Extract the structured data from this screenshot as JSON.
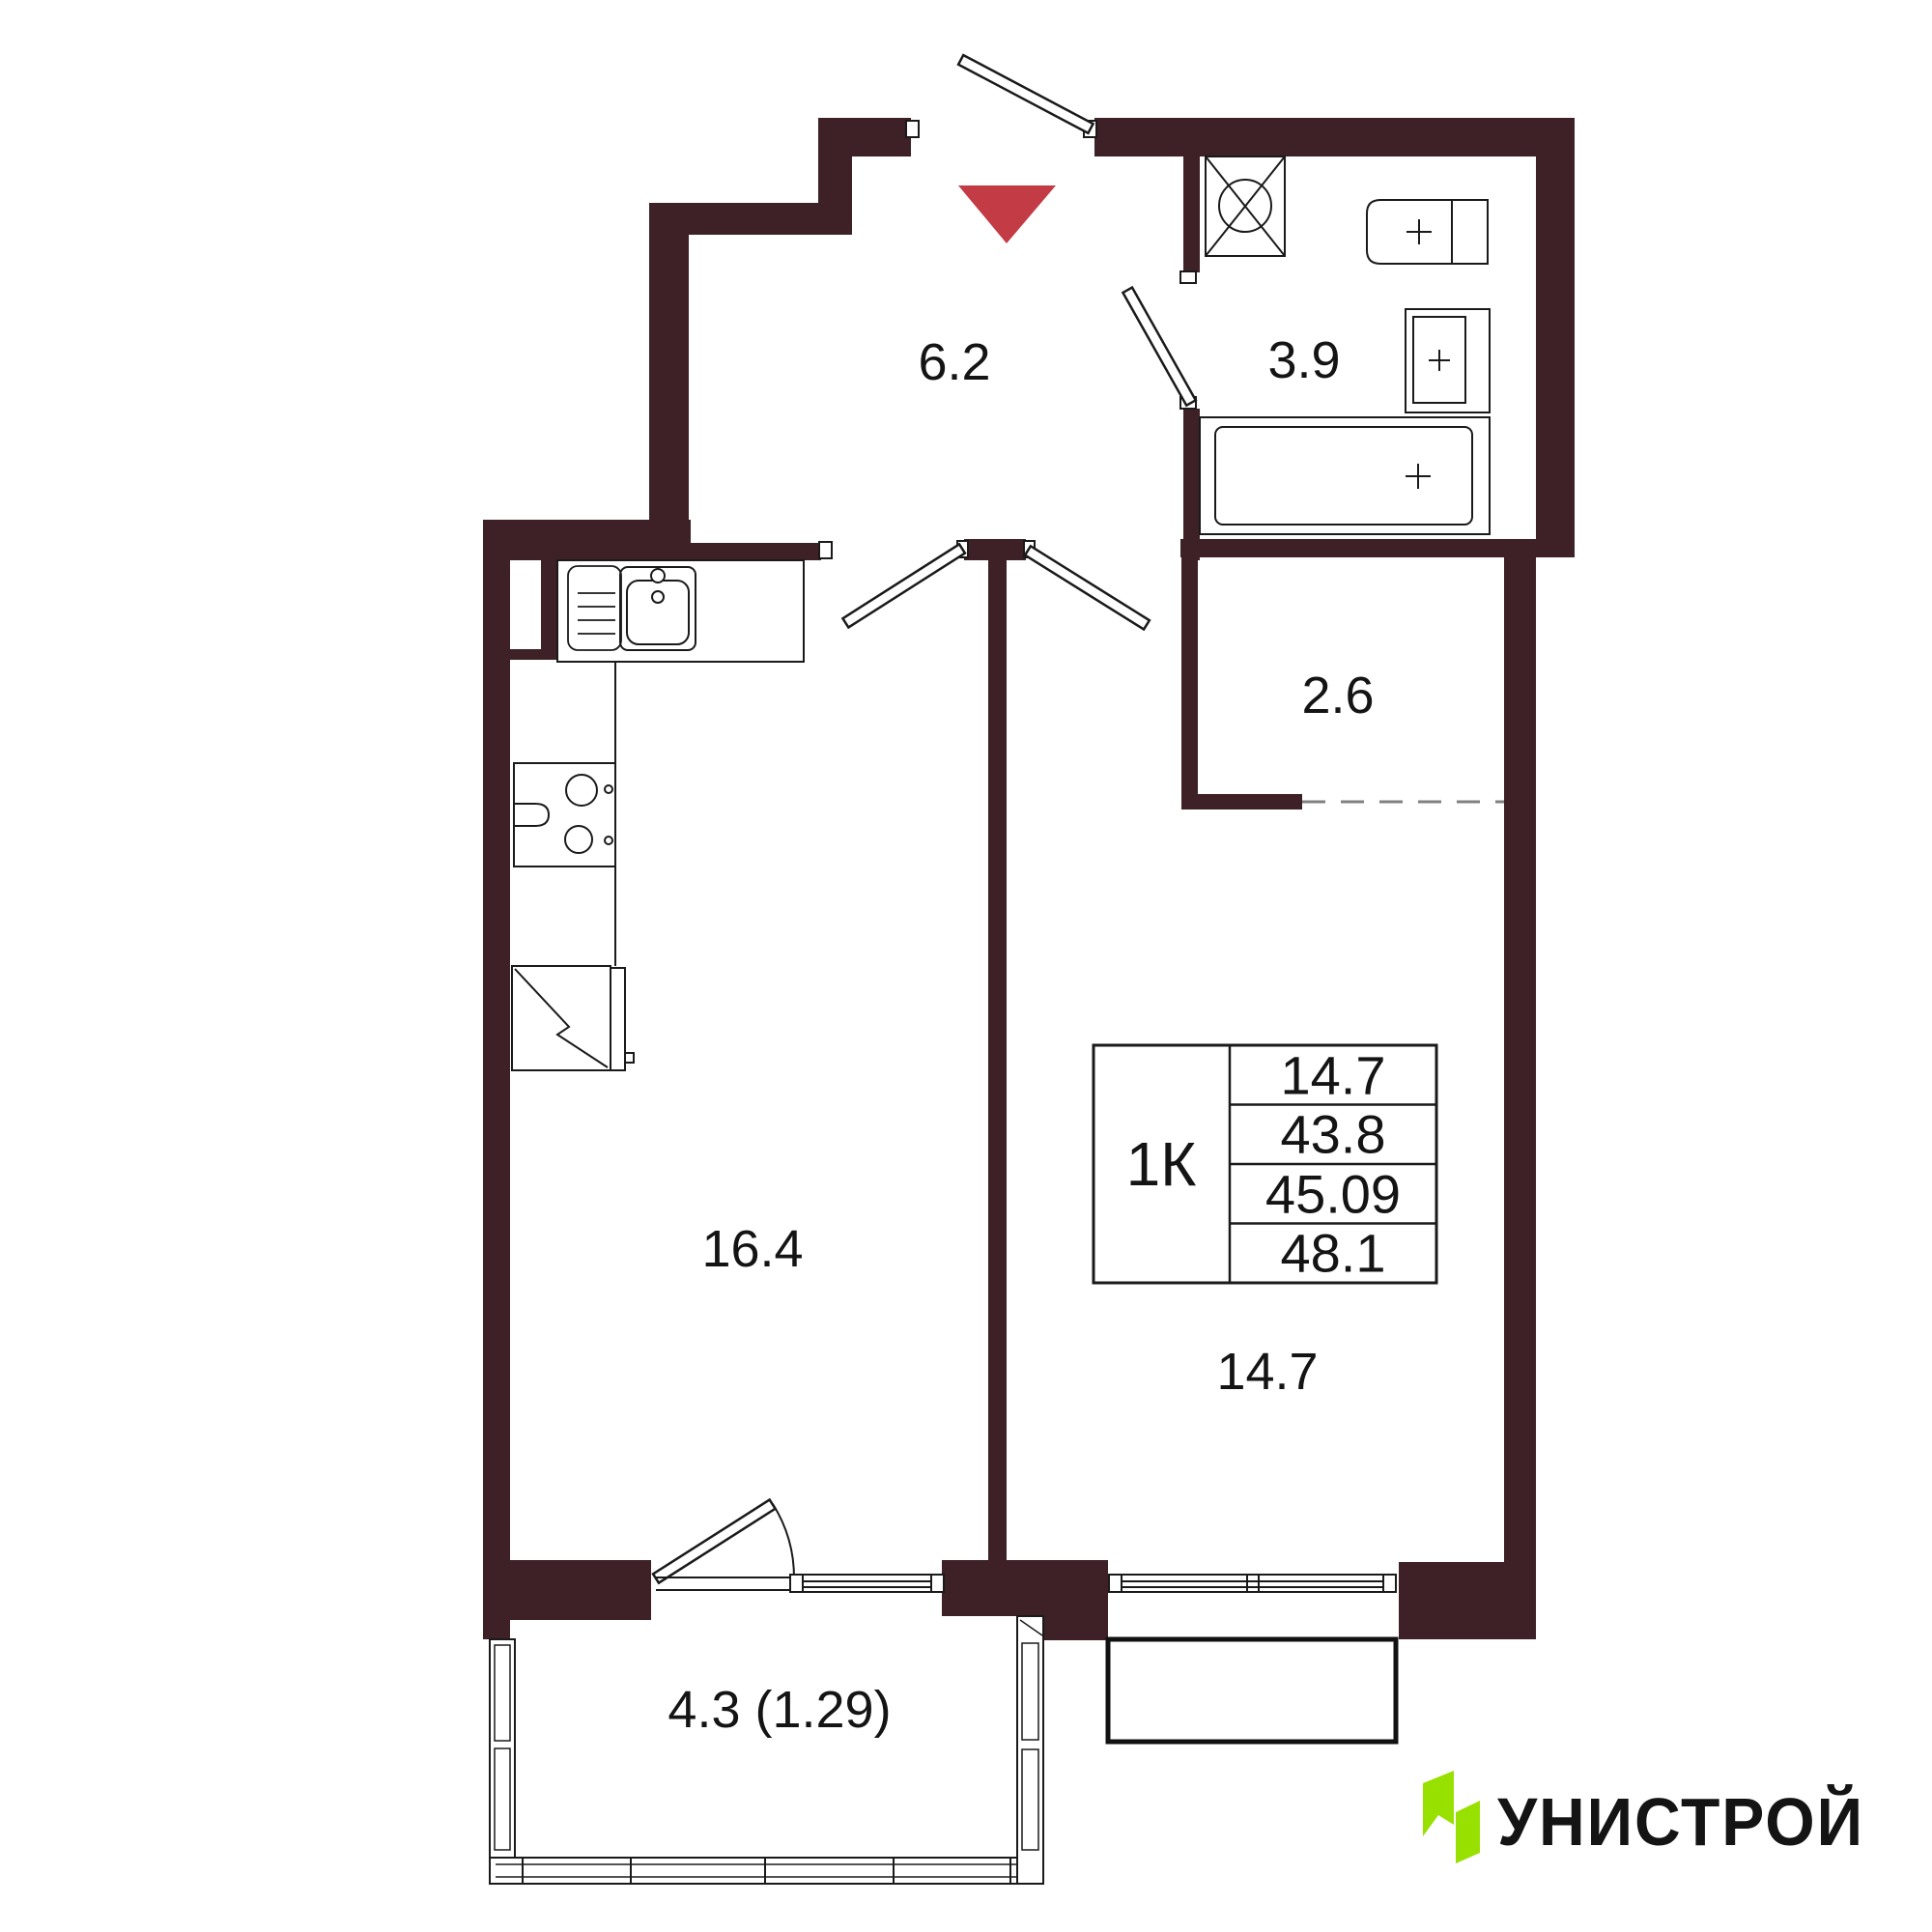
{
  "plan": {
    "rooms": [
      {
        "name": "hallway",
        "area": "6.2"
      },
      {
        "name": "bathroom",
        "area": "3.9"
      },
      {
        "name": "wardrobe",
        "area": "2.6"
      },
      {
        "name": "kitchen-living-room",
        "area": "16.4"
      },
      {
        "name": "bedroom",
        "area": "14.7"
      },
      {
        "name": "balcony",
        "area": "4.3 (1.29)"
      }
    ],
    "info_table": {
      "apartment_type": "1К",
      "row1": "14.7",
      "row2": "43.8",
      "row3": "45.09",
      "row4": "48.1"
    },
    "logo": {
      "text": "УНИСТРОЙ",
      "green": "#98E000",
      "text_color": "#3A4C4D"
    },
    "colors": {
      "wall": "#3D2126",
      "entrance_marker": "#C23B45",
      "line": "#1A1A1A"
    }
  }
}
